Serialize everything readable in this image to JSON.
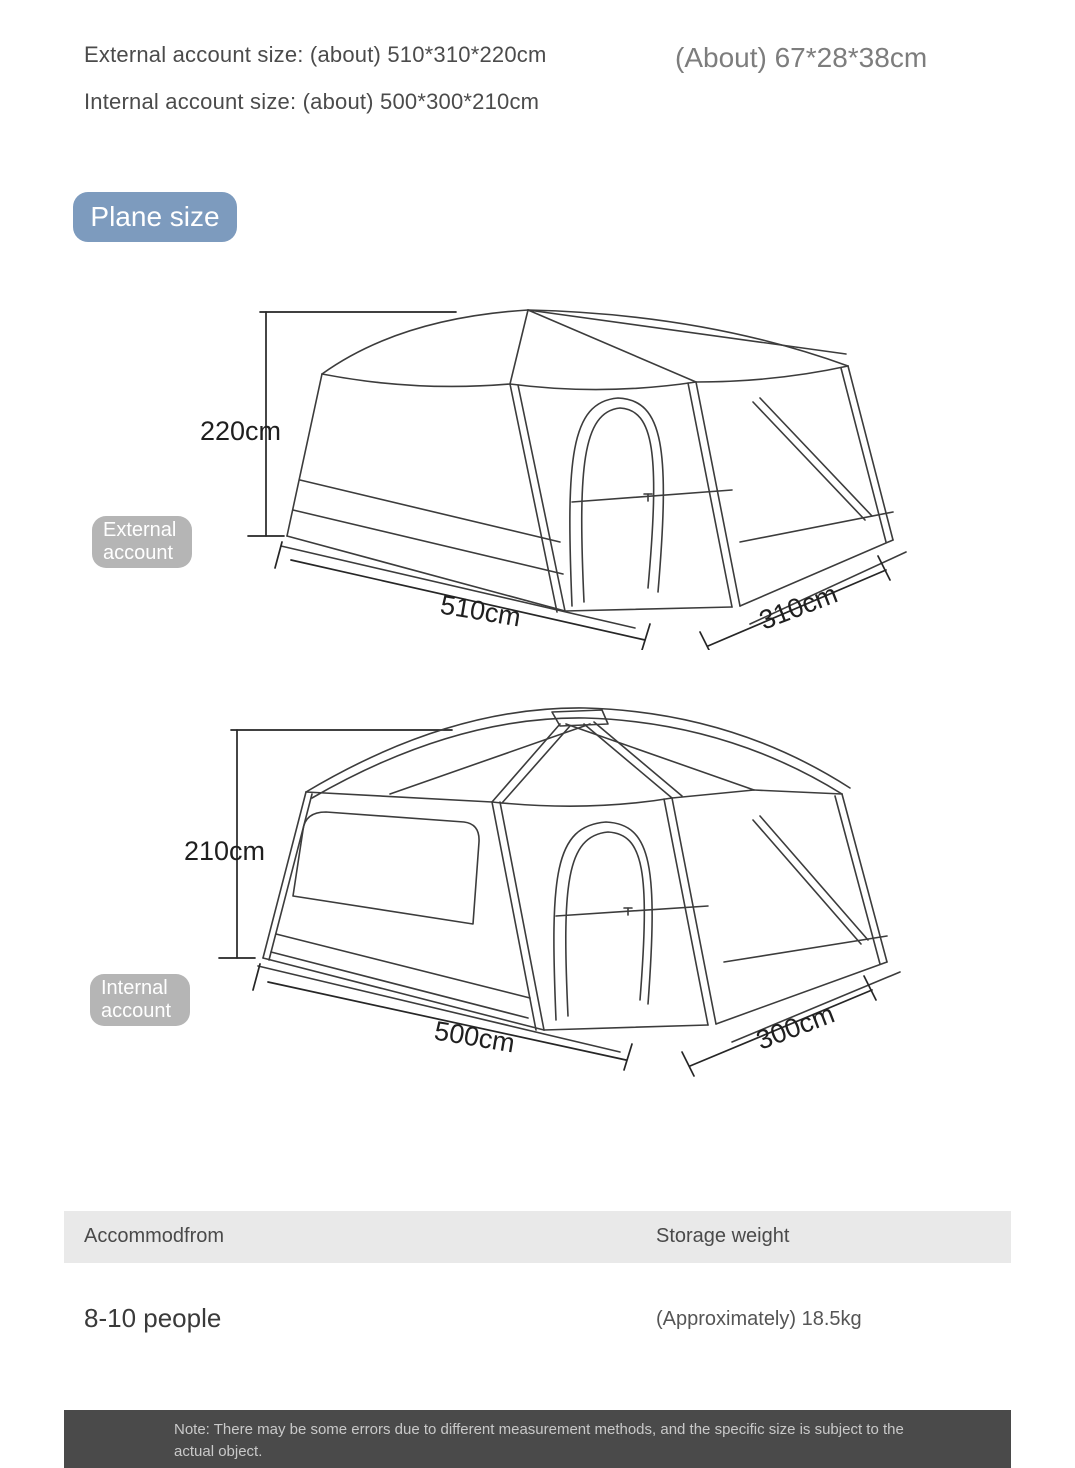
{
  "header": {
    "external_size": "External account size: (about) 510*310*220cm",
    "internal_size": "Internal account size: (about) 500*300*210cm",
    "packed_size": "(About) 67*28*38cm"
  },
  "plane_size_badge": "Plane size",
  "external_tent": {
    "badge": {
      "line1": "External",
      "line2": "account"
    },
    "height_label": "220cm",
    "width_label": "510cm",
    "depth_label": "310cm"
  },
  "internal_tent": {
    "badge": {
      "line1": "Internal",
      "line2": "account"
    },
    "height_label": "210cm",
    "width_label": "500cm",
    "depth_label": "300cm"
  },
  "spec_table": {
    "col1_header": "Accommodfrom",
    "col2_header": "Storage weight",
    "col1_value": "8-10 people",
    "col2_value": "(Approximately) 18.5kg"
  },
  "note": "Note: There may be some errors due to different measurement methods, and the specific size is subject to the actual object.",
  "colors": {
    "plane_badge_bg": "#7d9bbe",
    "tent_badge_bg": "#b5b5b5",
    "table_header_bg": "#e9e9e9",
    "note_bar_bg": "#4a4a4a",
    "line_art": "#3c3c3c"
  }
}
